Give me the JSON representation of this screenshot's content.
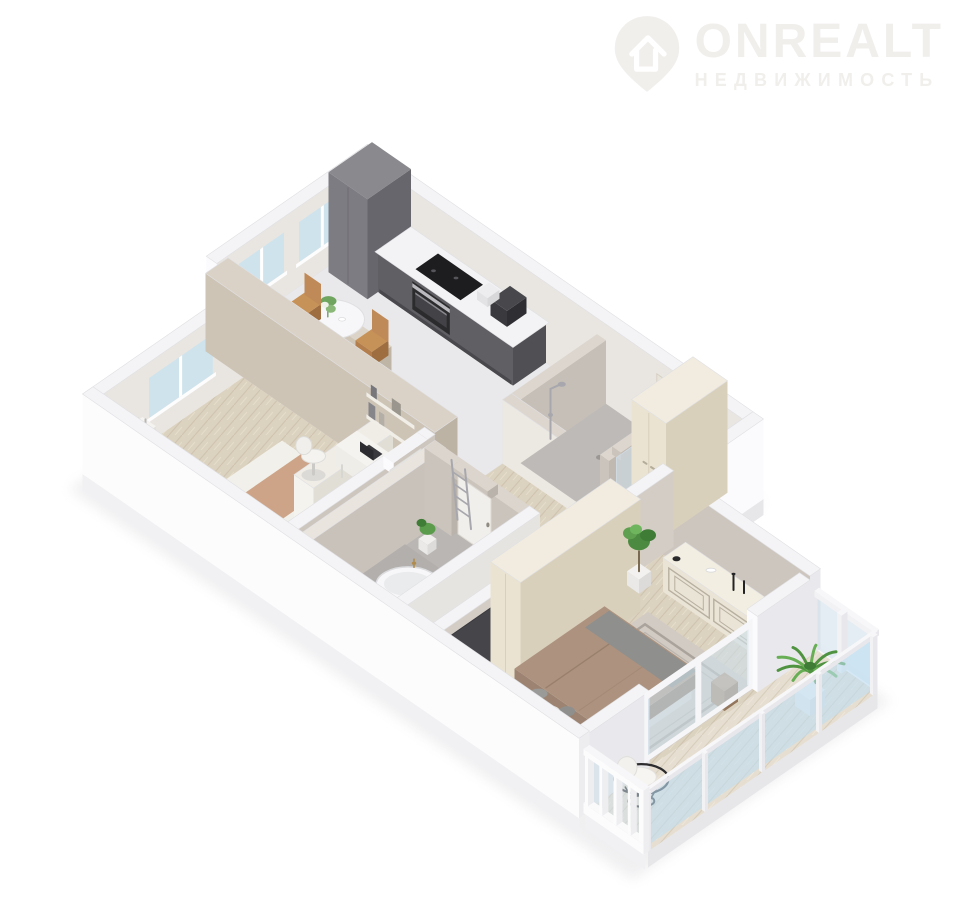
{
  "watermark": {
    "brand": "ONREALT",
    "tagline": "НЕДВИЖИМОСТЬ",
    "color": "#f1efec"
  },
  "scene": {
    "type": "isometric-3d-floorplan",
    "rooms": [
      "kitchen-living",
      "bedroom",
      "bathroom",
      "shower-room",
      "hallway",
      "entry",
      "master-bedroom",
      "balcony"
    ]
  },
  "palette": {
    "bg": "#ffffff",
    "wallTop": "#f4f4f6",
    "wallBright": "#fbfbfd",
    "wallSide": "#e9e9ed",
    "wallInnerWarm": "#e9e6e1",
    "greige": "#cdc6be",
    "slab": "#f1f1f3",
    "slabSide": "#e7e7ea",
    "tile": "#e9e9eb",
    "bathFloor": "#b9b6b3",
    "showerFloor": "#bdbab7",
    "wood": "#dcd2c0",
    "woodLight": "#e6ded0",
    "kitchenDark": "#77767b",
    "kitchenDarker": "#606064",
    "kitchenDarkest": "#505054",
    "counterTop": "#f3f3f5",
    "cream": "#eae3d2",
    "creamTop": "#f1ecdf",
    "creamSide": "#d9d0bc",
    "steel": "#b9b9be",
    "chrome": "#a7a7ad",
    "glass": "#cfe3ed",
    "sky": "#bfdff1",
    "gold": "#b08d4f",
    "black": "#232325",
    "bedBrown": "#ad937f",
    "pillow": "#f3f1ec",
    "grayThrow": "#8f8f8d",
    "rug": "#d1cbc4",
    "tan": "#c08a58",
    "green": "#5a9c4b",
    "greenDark": "#3f7c36"
  }
}
